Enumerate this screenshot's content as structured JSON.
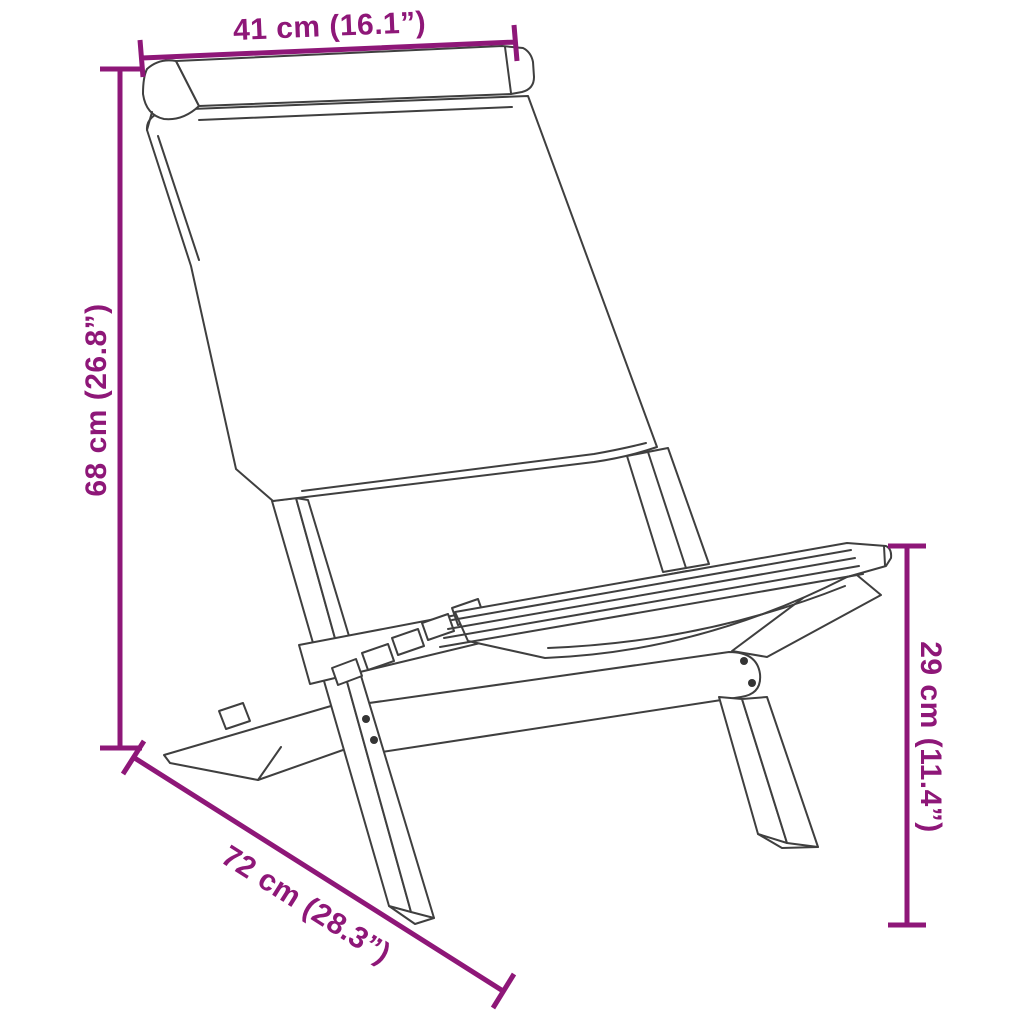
{
  "figure": {
    "name": "folding-chair-line-art",
    "description_visible": "isometric line drawing of a folding fabric chair"
  },
  "colors": {
    "dimension_accent": "#8E1778",
    "line_art": "#3F3F3F",
    "background": "#FFFFFF",
    "screw_dot": "#343434"
  },
  "dimensions": {
    "top_width": {
      "label": "41 cm (16.1”)"
    },
    "left_height": {
      "label": "68 cm (26.8”)"
    },
    "bottom_depth": {
      "label": "72 cm (28.3”)"
    },
    "right_seat_height": {
      "label": "29 cm (11.4”)"
    }
  }
}
